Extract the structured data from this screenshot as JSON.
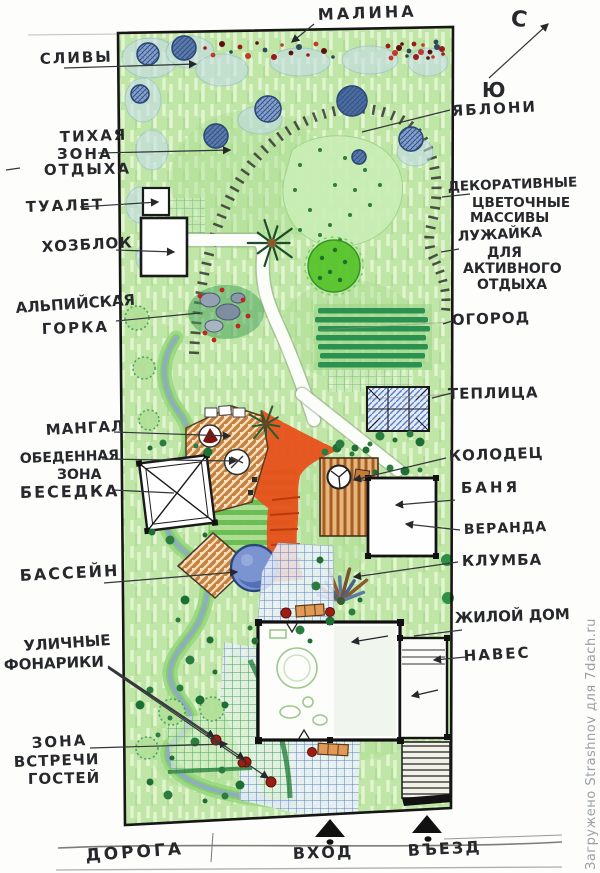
{
  "watermark": "Загружено Strashnov для 7dach.ru",
  "compass": {
    "north": "С",
    "south": "Ю"
  },
  "labels": {
    "malina": "МАЛИНА",
    "slivy": "СЛИВЫ",
    "yabloni": "ЯБЛОНИ",
    "quiet_zone": [
      "ТИХАЯ",
      "ЗОНА",
      "ОТДЫХА"
    ],
    "toilet": "ТУАЛЕТ",
    "hozblok": "ХОЗБЛОК",
    "alpine": [
      "АЛЬПИЙСКАЯ",
      "ГОРКА"
    ],
    "decorative": [
      "ДЕКОРАТИВНЫЕ",
      "ЦВЕТОЧНЫЕ",
      "МАССИВЫ"
    ],
    "lawn": [
      "ЛУЖАЙКА",
      "ДЛЯ",
      "АКТИВНОГО",
      "ОТДЫХА"
    ],
    "ogorod": "ОГОРОД",
    "teplitsa": "ТЕПЛИЦА",
    "mangal": "МАНГАЛ",
    "dining": [
      "ОБЕДЕННАЯ",
      "ЗОНА"
    ],
    "besedka": "БЕСЕДКА",
    "kolodets": "КОЛОДЕЦ",
    "banya": "БАНЯ",
    "veranda": "ВЕРАНДА",
    "basseyn": "БАССЕЙН",
    "klumba": "КЛУМБА",
    "zhiloy_dom": "ЖИЛОЙ ДОМ",
    "naves": "НАВЕС",
    "lights": [
      "УЛИЧНЫЕ",
      "ФОНАРИКИ"
    ],
    "guests": [
      "ЗОНА",
      "ВСТРЕЧИ",
      "ГОСТЕЙ"
    ],
    "doroga": "ДОРОГА",
    "vhod": "ВХОД",
    "vezd": "ВЪЕЗД"
  },
  "colors": {
    "plot_green": "#bfe6a6",
    "terrace_orange": "#e8501a",
    "pool_blue": "#7b94d0",
    "tree_blue": "#5f7cab",
    "lawn_bright": "#59c42c",
    "paving_blue": "#5c7fc4",
    "paving_green": "#3a9e55",
    "berry_red": "#9b1b1b",
    "compass_teal": "#1b8e8e",
    "ink": "#26282c"
  }
}
